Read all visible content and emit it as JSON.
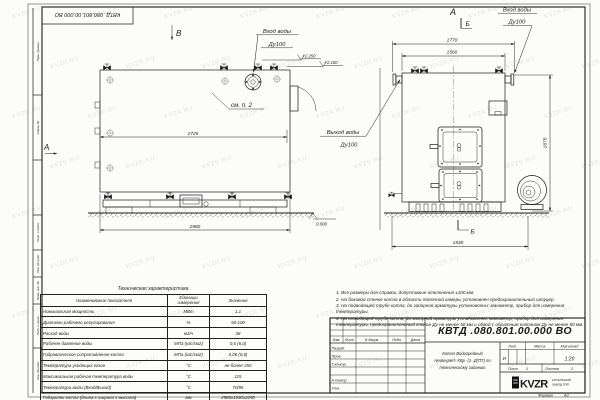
{
  "watermark": {
    "text": "KVZR.RU"
  },
  "stamp_top_left": {
    "doc_number": "КВТД .080.801.00.000  ВО"
  },
  "margin_labels": [
    "Перв. примен.",
    "Справ. №",
    "Подп. и дата",
    "Инв. № дубл.",
    "Взам. инв. №",
    "Подп. и дата",
    "Инв. № подл."
  ],
  "views": {
    "side_view": {
      "view_label": "В",
      "view_label_left": "А",
      "inlet_line1": "Вход воды",
      "inlet_line2": "Ду100",
      "outlet_line1": "Выход воды",
      "outlet_line2": "Ду100",
      "elev_top": "+2.250",
      "elev_mid": "+2.100",
      "elev_zero": "0.000",
      "note_ref": "см. п. 2",
      "dim_inner": "2725",
      "dim_overall": "2980"
    },
    "front_view": {
      "view_label": "А",
      "section_label_top": "Б",
      "section_label_bottom": "Б",
      "inlet_line1": "Вход воды",
      "inlet_line2": "Ду100",
      "dim_top_outer": "1770",
      "dim_top_inner": "1560",
      "dim_height": "1875",
      "dim_width": "1930"
    }
  },
  "notes": [
    "1. Все размеры для справок, допустимые отклонения ±100 мм.",
    "2. На боковой стенке котла в области топочной камеры установлен предохранительный штуцер",
    "3. На подводящей трубе котла, до запорной арматуры установлены: манометр, прибор для измерения температуры.",
    "4. На отводящей трубе котла, до запорной арматуры установлены: манометр, прибор для измерения температуры, предохранительный клапан Ду не менее 50 мм и обвод с обратным клапаном Ду не менее 50 мм."
  ],
  "spec_table": {
    "title": "Техническая характеристика",
    "headers": [
      "Наименование показателя",
      "Единицы измерения",
      "Значение"
    ],
    "rows": [
      [
        "Номинальная мощность",
        "МВт",
        "1,1"
      ],
      [
        "Диапазон рабочего регулирования",
        "%",
        "50-100"
      ],
      [
        "Расход воды",
        "м3/ч",
        "38"
      ],
      [
        "Рабочее давление воды",
        "МПа (кгс/см2)",
        "0,6 (6,0)"
      ],
      [
        "Гидравлическое сопротивление котла",
        "МПа (кгс/см2)",
        "0,06 (0,6)"
      ],
      [
        "Температура уходящих газов",
        "°С",
        "не более 250"
      ],
      [
        "Максимальная рабочая температура воды",
        "°С",
        "115"
      ],
      [
        "Температура воды (Вход/Выход)",
        "°С",
        "70/95"
      ],
      [
        "Габариты котла (длина х ширина х высота)",
        "мм",
        "2980х1930х2250"
      ]
    ]
  },
  "title_block": {
    "doc_number": "КВТД .080.801.00.000  ВО",
    "product_name_line1": "Котел Водогрейный",
    "product_name_line2": "Heatexpert- КВр -(1- Д/ПТ) по",
    "product_name_line3": "техническому заданию",
    "header_cols": [
      "Изм.",
      "Лист",
      "N докум.",
      "Подп.",
      "Дата"
    ],
    "sign_rows": [
      "Разраб.",
      "Пров.",
      "Т.контр.",
      "Н.контр.",
      "Утв."
    ],
    "lit_header": "Лит.",
    "mass_header": "Масса",
    "scale_header": "Масштаб",
    "lit_value": "И",
    "scale_value": "1:20",
    "sheet_label": "Лист",
    "sheet_value": "1",
    "sheets_label": "Листов",
    "sheets_value": "2",
    "logo_text": "KVZR",
    "logo_sub_line1": "КОТЕЛЬНЫЙ",
    "logo_sub_line2": "ЗАВОД РЭП",
    "format_label": "Формат",
    "format_value": "А3"
  }
}
